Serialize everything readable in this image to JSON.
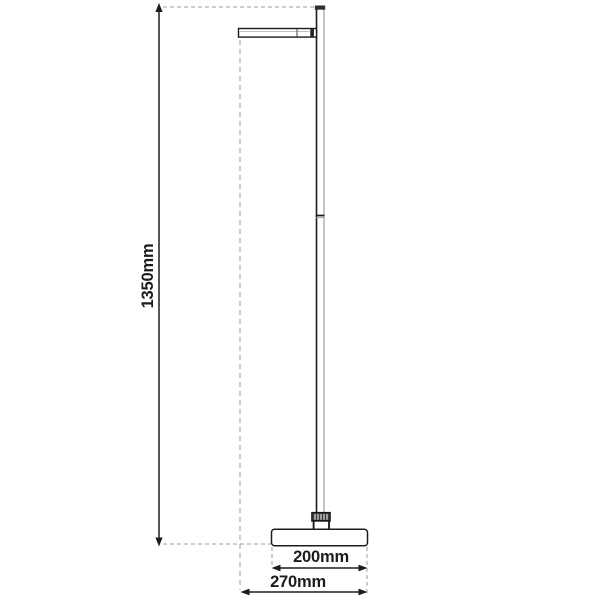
{
  "diagram": {
    "height_label": "1350mm",
    "base_width_label": "200mm",
    "total_width_label": "270mm"
  },
  "colors": {
    "line": "#1c1c1c",
    "extension_line": "#9c9c9c",
    "pole_shade": "#8a8a8a",
    "background": "#ffffff"
  }
}
